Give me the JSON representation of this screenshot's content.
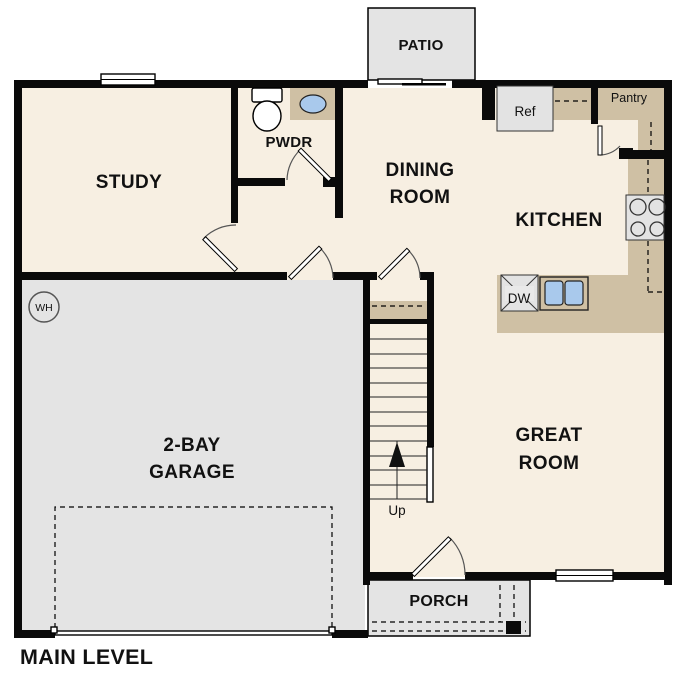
{
  "plan": {
    "title": "MAIN LEVEL"
  },
  "rooms": {
    "study": {
      "label": "STUDY"
    },
    "powder": {
      "label": "PWDR"
    },
    "dining": {
      "line1": "DINING",
      "line2": "ROOM"
    },
    "kitchen": {
      "label": "KITCHEN"
    },
    "pantry": {
      "label": "Pantry"
    },
    "great": {
      "line1": "GREAT",
      "line2": "ROOM"
    },
    "garage": {
      "line1": "2-BAY",
      "line2": "GARAGE"
    },
    "patio": {
      "label": "PATIO"
    },
    "porch": {
      "label": "PORCH"
    }
  },
  "fixtures": {
    "refrigerator": "Ref",
    "dishwasher": "DW",
    "water_heater": "WH"
  },
  "stairs": {
    "direction": "Up"
  },
  "colors": {
    "floor": "#f7efe2",
    "hard_surface": "#e4e4e4",
    "counter": "#cfc0a4",
    "sink": "#a9c9ec",
    "wall": "#0a0a0a",
    "appliance": "#e3e3e3"
  }
}
